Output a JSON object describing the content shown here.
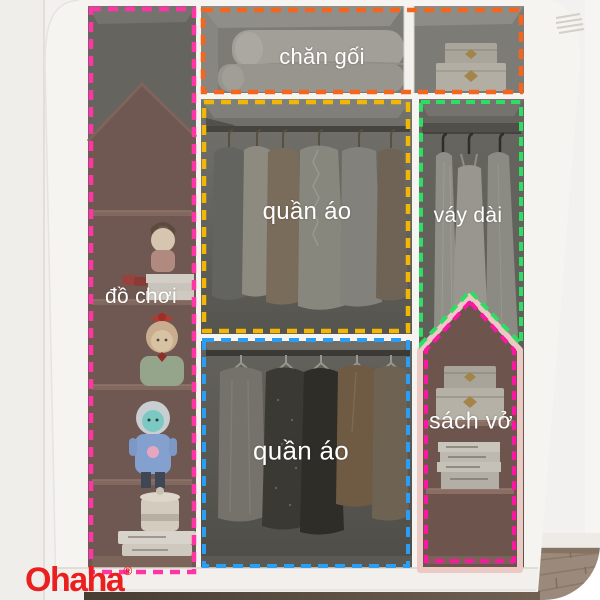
{
  "photo": {
    "description_labels_language": "vi",
    "label_text_color": "#ffffff",
    "regions": [
      {
        "name": "bedding",
        "label": "chăn gối",
        "outline_color": "#f4661f"
      },
      {
        "name": "toys",
        "label": "đồ chơi",
        "outline_color": "#ff35a5"
      },
      {
        "name": "clothes-upper",
        "label": "quần áo",
        "outline_color": "#f2b705"
      },
      {
        "name": "long-dresses",
        "label": "váy dài",
        "outline_color": "#2edd63"
      },
      {
        "name": "clothes-lower",
        "label": "quần áo",
        "outline_color": "#2a9df4"
      },
      {
        "name": "books",
        "label": "sách vở",
        "outline_color": "#fb16a3"
      }
    ]
  },
  "brand": {
    "name": "Ohaha",
    "registered_mark": "®",
    "color": "#e9201f"
  }
}
